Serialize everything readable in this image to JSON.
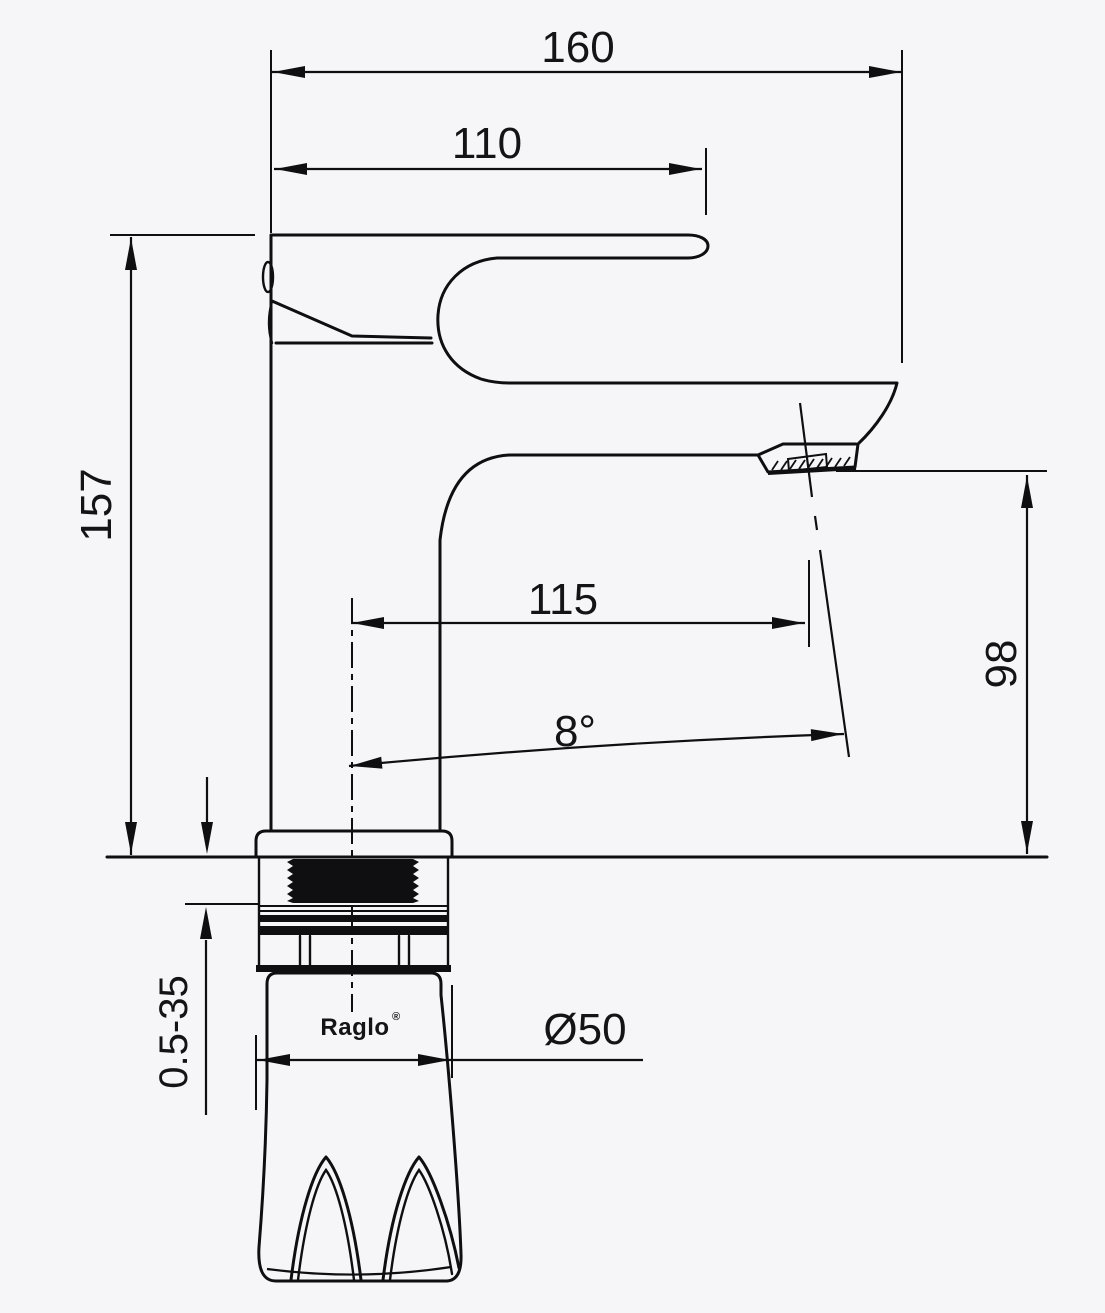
{
  "brand": {
    "name": "Raglo",
    "mark": "®"
  },
  "dimensions": {
    "overall_length": "160",
    "handle_length": "110",
    "total_height": "157",
    "spout_reach": "115",
    "spout_angle": "8°",
    "outlet_height": "98",
    "base_diameter": "Ø50",
    "deck_thickness_range": "0.5-35"
  },
  "colors": {
    "background": "#f6f6f8",
    "line": "#0f0f11"
  }
}
